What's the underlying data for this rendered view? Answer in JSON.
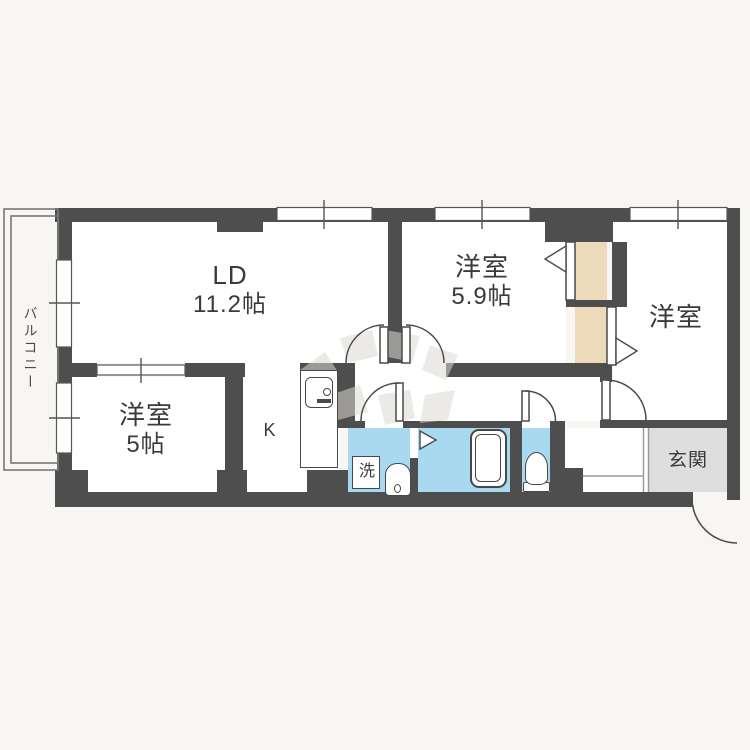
{
  "floorplan": {
    "rooms": {
      "balcony": {
        "label": "バルコニー"
      },
      "living_dining": {
        "label": "LD",
        "size": "11.2帖"
      },
      "bedroom_a": {
        "label": "洋室",
        "size": "5.9帖"
      },
      "bedroom_b": {
        "label": "洋室"
      },
      "bedroom_c": {
        "label": "洋室",
        "size": "5帖"
      },
      "kitchen": {
        "label": "K"
      },
      "washer": {
        "label": "洗"
      },
      "entrance": {
        "label": "玄関"
      }
    },
    "colors": {
      "wall": "#4e4e4e",
      "wet_area_blue": "#a9d9f1",
      "closet_beige": "#eddaba",
      "entry_gray": "#dedede",
      "background": "#f7f6f3",
      "line": "#4a4a4a"
    },
    "icons": {
      "bathtub": "bathtub-icon",
      "toilet": "toilet-icon",
      "washbasin": "washbasin-icon",
      "kitchen_sink": "kitchen-sink-icon"
    }
  }
}
